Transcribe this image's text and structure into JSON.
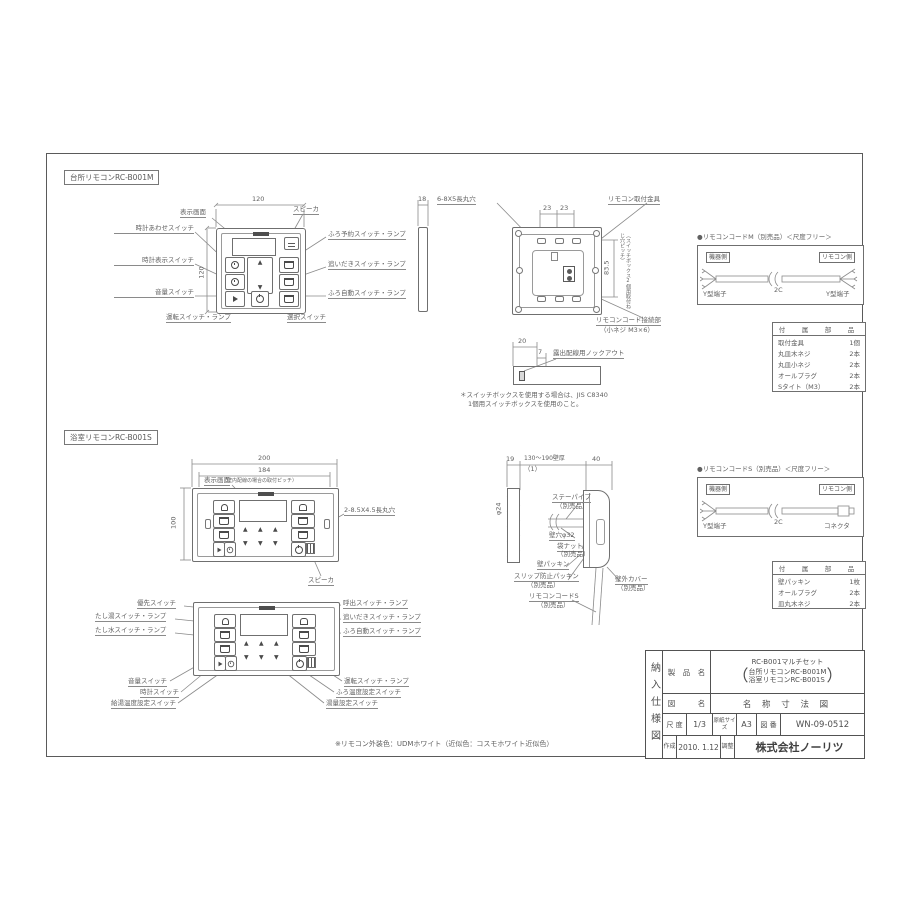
{
  "kitchen": {
    "section_title": "台所リモコンRC-B001M",
    "dim_width": "120",
    "dim_height": "120",
    "dim_depth": "18",
    "labels": {
      "display": "表示画面",
      "speaker": "スピーカ",
      "clock_set": "時計あわせスイッチ",
      "clock_disp": "時計表示スイッチ",
      "volume": "音量スイッチ",
      "bath_reserve": "ふろ予約スイッチ・ランプ",
      "reheat": "追いだきスイッチ・ランプ",
      "bath_auto": "ふろ自動スイッチ・ランプ",
      "operation": "運転スイッチ・ランプ",
      "select": "選択スイッチ"
    }
  },
  "kitchen_back": {
    "holes": "6-8X5長丸穴",
    "dim_23a": "23",
    "dim_23b": "23",
    "bracket": "リモコン取付金具",
    "dim_835": "83.5",
    "pitch_note": "（スイッチボックス2個用取付ねじ穴ピッチ）",
    "cord_conn": "リモコンコード接続部",
    "cord_screw": "（小ネジ M3×6）"
  },
  "knockout": {
    "dim20": "20",
    "dim7": "7",
    "label": "露出配線用ノックアウト"
  },
  "jis_note": {
    "line1": "＊スイッチボックスを使用する場合は、JIS C8340",
    "line2": "1個用スイッチボックスを使用のこと。"
  },
  "cord_m": {
    "title": "●リモコンコードM（別売品）＜尺度フリー＞",
    "left_side": "機器側",
    "right_side": "リモコン側",
    "left_term": "Y型端子",
    "cable": "2C",
    "right_term": "Y型端子"
  },
  "parts_m": {
    "header": "付　属　部　品",
    "rows": [
      {
        "name": "取付金具",
        "qty": "1個"
      },
      {
        "name": "丸皿木ネジ",
        "qty": "2本"
      },
      {
        "name": "丸皿小ネジ",
        "qty": "2本"
      },
      {
        "name": "オールプラグ",
        "qty": "2本"
      },
      {
        "name": "Sタイト（M3）",
        "qty": "2本"
      }
    ]
  },
  "bath": {
    "section_title": "浴室リモコンRC-B001S",
    "dim_200": "200",
    "dim_184": "184",
    "pitch": "（壁内配線の場合の取付ピッチ）",
    "display": "表示画面",
    "dim_100": "100",
    "holes": "2-8.5X4.5長丸穴",
    "speaker": "スピーカ"
  },
  "bath_callouts": {
    "priority": "優先スイッチ",
    "add_hot": "たし湯スイッチ・ランプ",
    "add_cold": "たし水スイッチ・ランプ",
    "volume": "音量スイッチ",
    "clock": "時計スイッチ",
    "dhw_temp": "給湯温度設定スイッチ",
    "call": "呼出スイッチ・ランプ",
    "reheat": "追いだきスイッチ・ランプ",
    "auto": "ふろ自動スイッチ・ランプ",
    "operation": "運転スイッチ・ランプ",
    "bath_temp": "ふろ温度設定スイッチ",
    "amount": "湯量設定スイッチ"
  },
  "bath_side": {
    "dim19": "19",
    "wall": "130〜190壁厚",
    "dim40": "40",
    "note1": "（1）",
    "dia24": "φ24",
    "stay": "ステーパイプ",
    "stay2": "（別売品）",
    "hole": "壁穴φ32",
    "nut": "袋ナット",
    "nut2": "（別売品）",
    "packing": "壁パッキン",
    "slip": "スリップ防止パッキン",
    "slip2": "（別売品）",
    "cord": "リモコンコードS",
    "cord2": "（別売品）",
    "cover": "壁外カバー",
    "cover2": "（別売品）"
  },
  "cord_s": {
    "title": "●リモコンコードS（別売品）＜尺度フリー＞",
    "left_side": "機器側",
    "right_side": "リモコン側",
    "left_term": "Y型端子",
    "cable": "2C",
    "right_term": "コネクタ"
  },
  "parts_s": {
    "header": "付　属　部　品",
    "rows": [
      {
        "name": "壁パッキン",
        "qty": "1枚"
      },
      {
        "name": "オールプラグ",
        "qty": "2本"
      },
      {
        "name": "皿丸木ネジ",
        "qty": "2本"
      }
    ]
  },
  "color_note": "※リモコン外装色：UDMホワイト（近似色：コスモホワイト近似色）",
  "titleblock": {
    "side": "納入仕様図",
    "product_label": "製　品　名",
    "product1": "RC-B001マルチセット",
    "product2": "台所リモコンRC-B001M",
    "product3": "浴室リモコンRC-B001S",
    "drawing_label": "図　　　名",
    "drawing_name": "名 称 寸 法 図",
    "scale_label": "尺 度",
    "scale": "1/3",
    "paper_label": "原紙サイズ",
    "paper": "A3",
    "no_label": "図 番",
    "no": "WN-09-0512",
    "created_label": "作成",
    "created": "2010. 1.12",
    "adjusted_label": "調整",
    "company": "株式会社ノーリツ"
  }
}
